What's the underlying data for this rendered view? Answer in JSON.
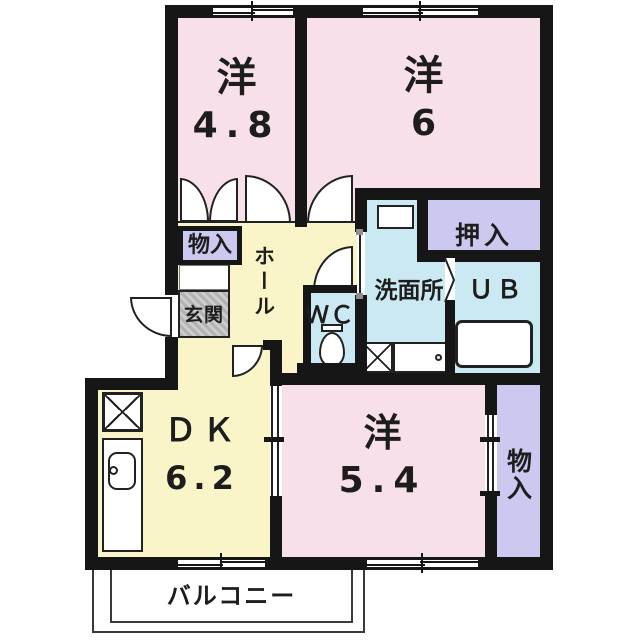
{
  "floorplan": {
    "type": "apartment-floor-plan-2DK",
    "colors": {
      "wall": "#161616",
      "western_room_pink": "#F8E0EB",
      "hall_dk_yellow": "#FAF5C8",
      "wet_area_blue": "#CBE9F2",
      "closet_purple": "#CBC9F0",
      "entrance_gray": "#BDBDBD"
    },
    "rooms": {
      "western1": {
        "label": "洋",
        "size": "4.8"
      },
      "western2": {
        "label": "洋",
        "size": "6"
      },
      "western3": {
        "label": "洋",
        "size": "5.4"
      },
      "dining_kitchen": {
        "label": "ＤＫ",
        "size": "6.2"
      },
      "hall": {
        "label": "ホール"
      },
      "entrance": {
        "label": "玄関"
      },
      "toilet": {
        "label": "ＷＣ"
      },
      "washroom": {
        "label": "洗面所"
      },
      "unit_bath": {
        "label": "ＵＢ"
      },
      "oshiire": {
        "label": "押入"
      },
      "storage_upper": {
        "label": "物入"
      },
      "storage_lower": {
        "label": "物入"
      },
      "balcony": {
        "label": "バルコニー"
      }
    }
  }
}
